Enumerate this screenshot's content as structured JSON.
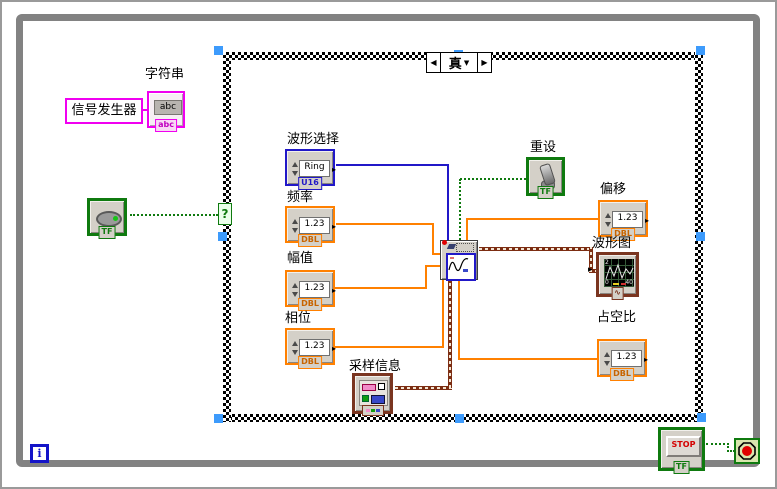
{
  "while_loop": {
    "iteration_terminal": "i"
  },
  "case_structure": {
    "selector_value": "真",
    "prev_arrow": "◀",
    "next_arrow": "▶",
    "dropdown_arrow": "▼",
    "selector_terminal": "?"
  },
  "string_constant": {
    "text": "信号发生器"
  },
  "string_indicator": {
    "label": "字符串",
    "value": "abc",
    "type_label": "abc"
  },
  "left_boolean": {
    "type_label": "TF"
  },
  "waveform_select": {
    "label": "波形选择",
    "display": "Ring",
    "type_label": "U16"
  },
  "frequency": {
    "label": "频率",
    "value": "1.23",
    "type_label": "DBL"
  },
  "amplitude": {
    "label": "幅值",
    "value": "1.23",
    "type_label": "DBL"
  },
  "phase": {
    "label": "相位",
    "value": "1.23",
    "type_label": "DBL"
  },
  "sampling_info": {
    "label": "采样信息"
  },
  "reset": {
    "label": "重设",
    "type_label": "TF"
  },
  "offset": {
    "label": "偏移",
    "value": "1.23",
    "type_label": "DBL"
  },
  "waveform_chart": {
    "label": "波形图",
    "y_top": "2",
    "x_left": "0",
    "x_right": "40"
  },
  "duty_cycle": {
    "label": "占空比",
    "value": "1.23",
    "type_label": "DBL"
  },
  "stop": {
    "button_label": "STOP",
    "type_label": "TF"
  },
  "colors": {
    "dbl_orange": "#ff8000",
    "ring_blue": "#2118c8",
    "bool_green": "#0f7a0f",
    "string_pink": "#f000f0",
    "waveform_brown": "#7c2d12",
    "selection_handle_blue": "#3d9bfc"
  }
}
